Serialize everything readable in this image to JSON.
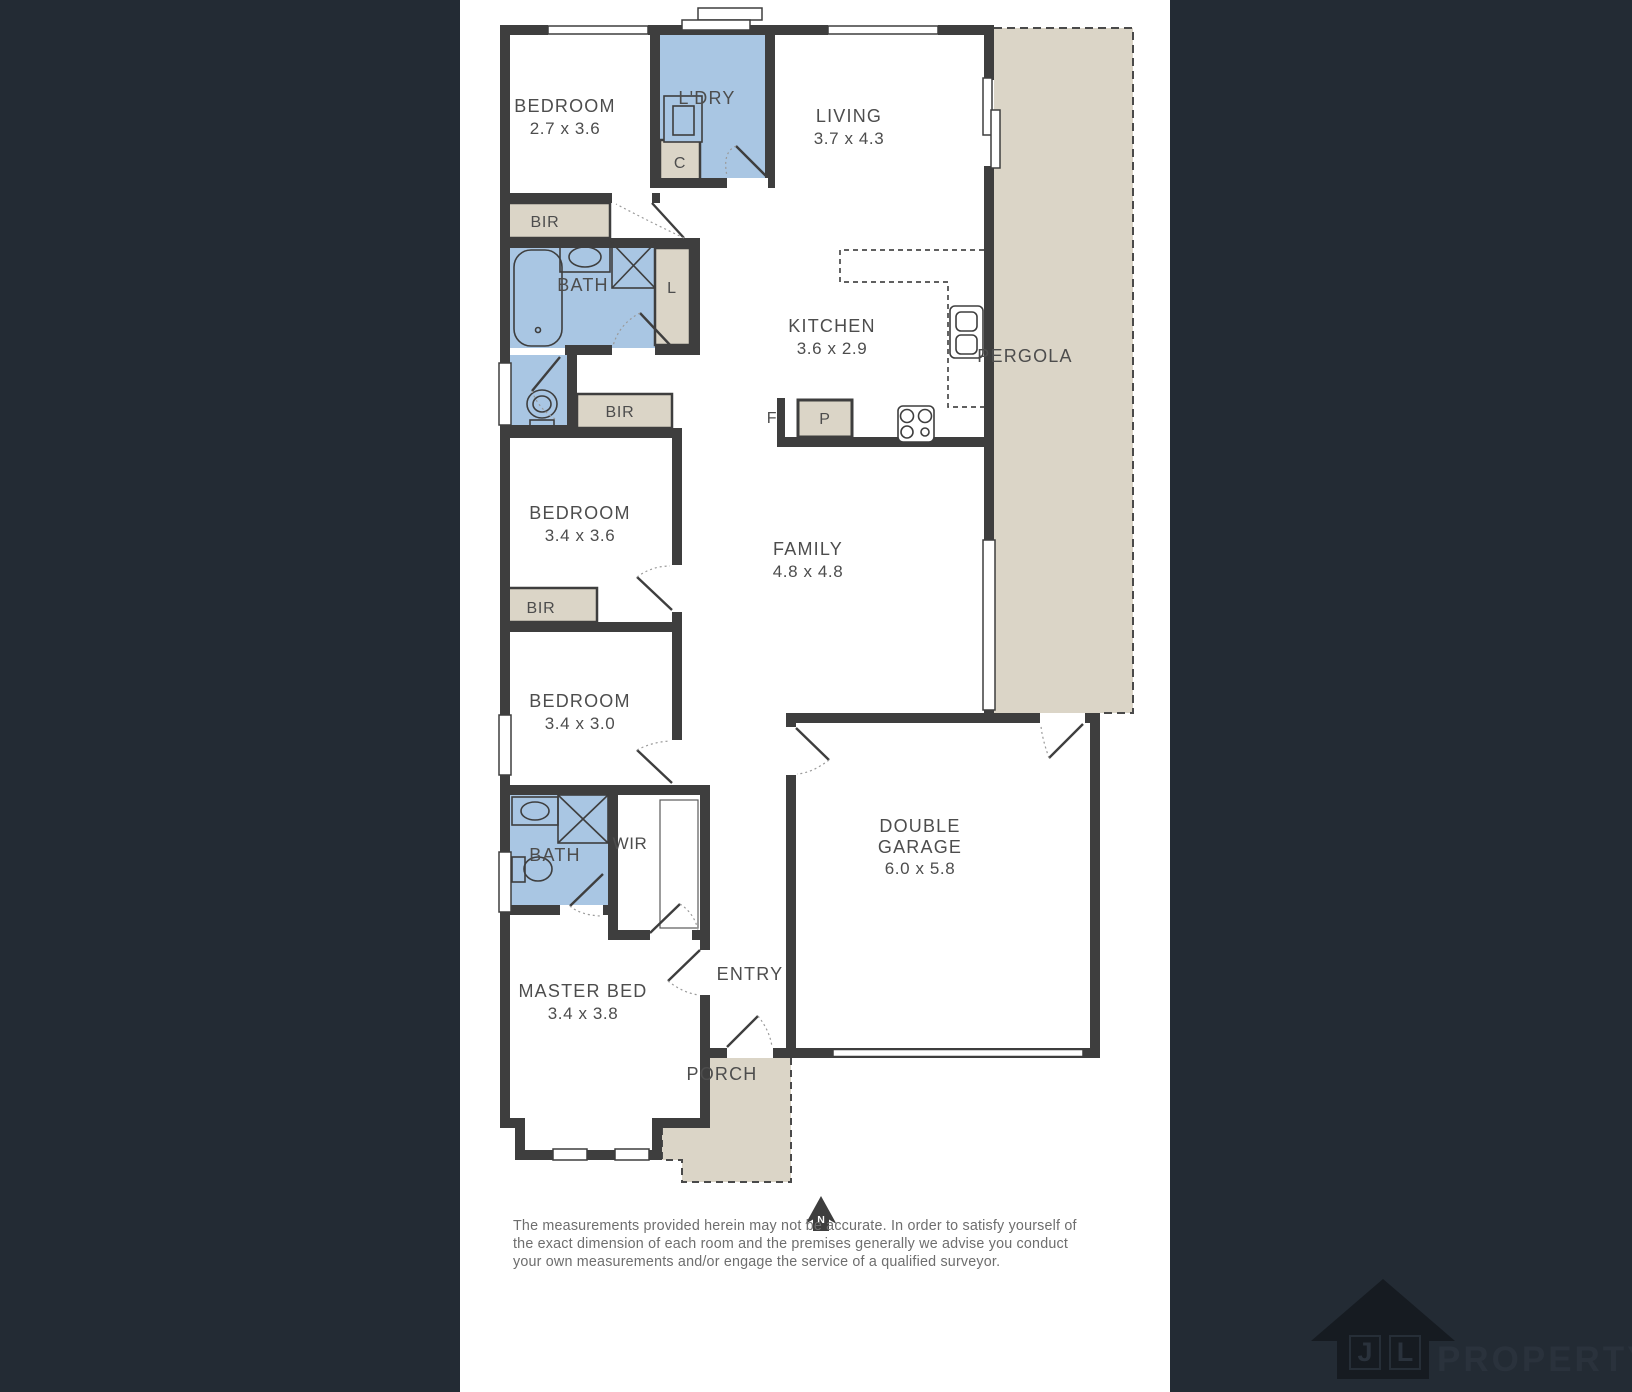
{
  "colors": {
    "background": "#232B34",
    "floor": "#FFFFFF",
    "wall": "#3E3E3E",
    "wet_area_blue": "#A9C6E3",
    "outdoor_beige": "#DBD5C7",
    "label_text": "#4D4D4D",
    "disclaimer_text": "#6E6E6E"
  },
  "rooms": {
    "bedroom1": {
      "label": "BEDROOM",
      "dims": "2.7 x 3.6"
    },
    "laundry": {
      "label": "L'DRY"
    },
    "living": {
      "label": "LIVING",
      "dims": "3.7 x 4.3"
    },
    "bath1": {
      "label": "BATH"
    },
    "kitchen": {
      "label": "KITCHEN",
      "dims": "3.6 x 2.9"
    },
    "pergola": {
      "label": "PERGOLA"
    },
    "bedroom2": {
      "label": "BEDROOM",
      "dims": "3.4 x 3.6"
    },
    "family": {
      "label": "FAMILY",
      "dims": "4.8 x 4.8"
    },
    "bedroom3": {
      "label": "BEDROOM",
      "dims": "3.4 x 3.0"
    },
    "bath2": {
      "label": "BATH"
    },
    "wir": {
      "label": "WIR"
    },
    "entry": {
      "label": "ENTRY"
    },
    "master_bed": {
      "label": "MASTER BED",
      "dims": "3.4 x 3.8"
    },
    "garage": {
      "label_line1": "DOUBLE",
      "label_line2": "GARAGE",
      "dims": "6.0 x 5.8"
    },
    "porch": {
      "label": "PORCH"
    }
  },
  "closets": {
    "bir1": "BIR",
    "bir2": "BIR",
    "bir3": "BIR",
    "cupboard": "C",
    "linen": "L",
    "fridge": "F",
    "pantry": "P"
  },
  "compass": {
    "north": "N"
  },
  "disclaimer": {
    "line1": "The measurements provided herein may not be accurate. In order to satisfy yourself of",
    "line2": "the exact dimension of each room and the premises generally we advise you conduct",
    "line3": "your own measurements and/or engage the service of a qualified surveyor."
  },
  "logo": {
    "letter1": "J",
    "letter2": "L",
    "name": "PROPERTY"
  }
}
